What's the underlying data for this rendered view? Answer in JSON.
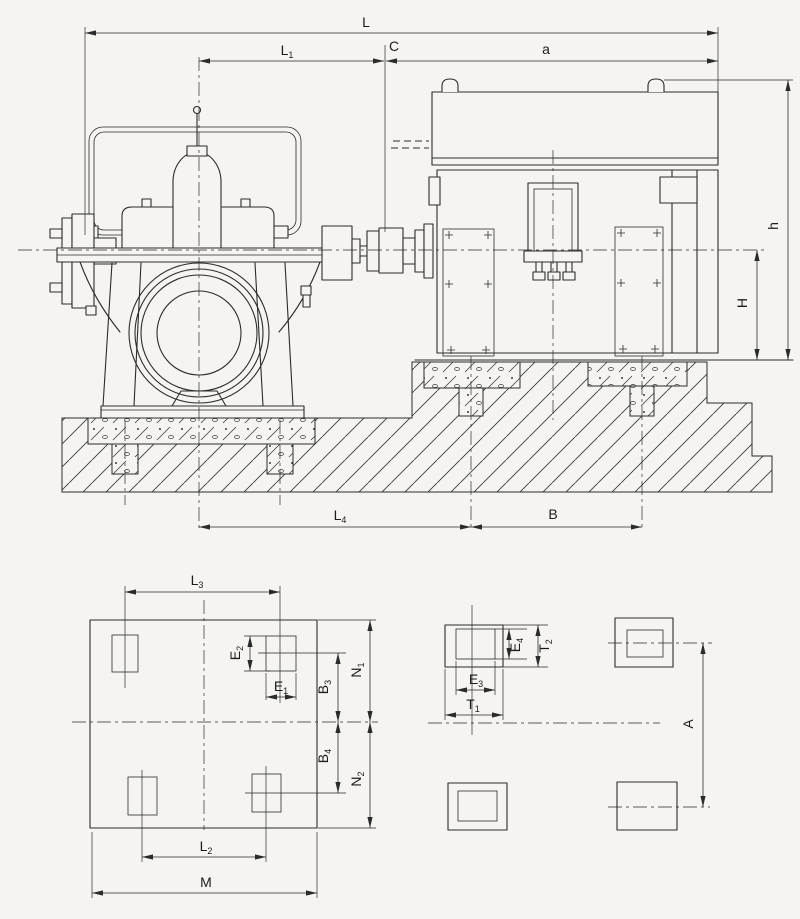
{
  "colors": {
    "paper": "#f5f4f0",
    "ink": "#2b2b2b"
  },
  "dimension_labels": {
    "elevation_top": [
      {
        "id": "L",
        "base": "L",
        "sub": ""
      },
      {
        "id": "L1",
        "base": "L",
        "sub": "1"
      },
      {
        "id": "C",
        "base": "C",
        "sub": ""
      },
      {
        "id": "a",
        "base": "a",
        "sub": ""
      }
    ],
    "elevation_right": [
      {
        "id": "h",
        "base": "h",
        "sub": ""
      },
      {
        "id": "H",
        "base": "H",
        "sub": ""
      }
    ],
    "elevation_bottom": [
      {
        "id": "L4",
        "base": "L",
        "sub": "4"
      },
      {
        "id": "B",
        "base": "B",
        "sub": ""
      }
    ],
    "pump_foundation_plan": [
      {
        "id": "L3",
        "base": "L",
        "sub": "3"
      },
      {
        "id": "E2",
        "base": "E",
        "sub": "2"
      },
      {
        "id": "E1",
        "base": "E",
        "sub": "1"
      },
      {
        "id": "B3",
        "base": "B",
        "sub": "3"
      },
      {
        "id": "N1",
        "base": "N",
        "sub": "1"
      },
      {
        "id": "B4",
        "base": "B",
        "sub": "4"
      },
      {
        "id": "N2",
        "base": "N",
        "sub": "2"
      },
      {
        "id": "L2",
        "base": "L",
        "sub": "2"
      },
      {
        "id": "M",
        "base": "M",
        "sub": ""
      }
    ],
    "motor_foundation_plan": [
      {
        "id": "E3",
        "base": "E",
        "sub": "3"
      },
      {
        "id": "E4",
        "base": "E",
        "sub": "4"
      },
      {
        "id": "T1",
        "base": "T",
        "sub": "1"
      },
      {
        "id": "T2",
        "base": "T",
        "sub": "2"
      },
      {
        "id": "A",
        "base": "A",
        "sub": ""
      }
    ]
  }
}
